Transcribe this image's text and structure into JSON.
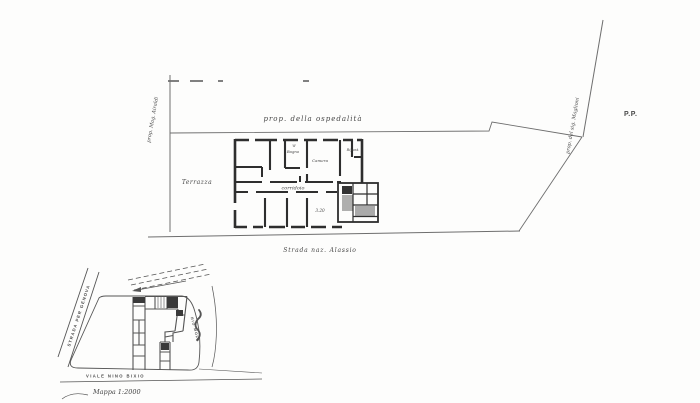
{
  "document": {
    "type": "scanned architectural drawing",
    "paper_color": "#fdfdfc",
    "ink_color": "#2e2e2e",
    "faint_line_color": "#6e6e6e"
  },
  "floor_plan": {
    "labels": {
      "top_property": "prop. della ospedalità",
      "left_property": "prop. Mag. Airaldi",
      "right_property": "prop. del sig. Maglioni",
      "pp": "P.P.",
      "terrace": "Terrazza",
      "corridor": "corridoio",
      "bath": "Bagno",
      "bath_w": "W",
      "room_center": "Camera",
      "closet": "Ripost.",
      "dimension": "3.20",
      "street": "Strada naz. Alassio"
    }
  },
  "site_map": {
    "labels": {
      "road_upper": "STRADA PER GENOVA",
      "road_lower": "VIALE  NINO  BIXIO",
      "stream": "RIO MOLA",
      "scale": "Mappa 1:2000"
    }
  }
}
